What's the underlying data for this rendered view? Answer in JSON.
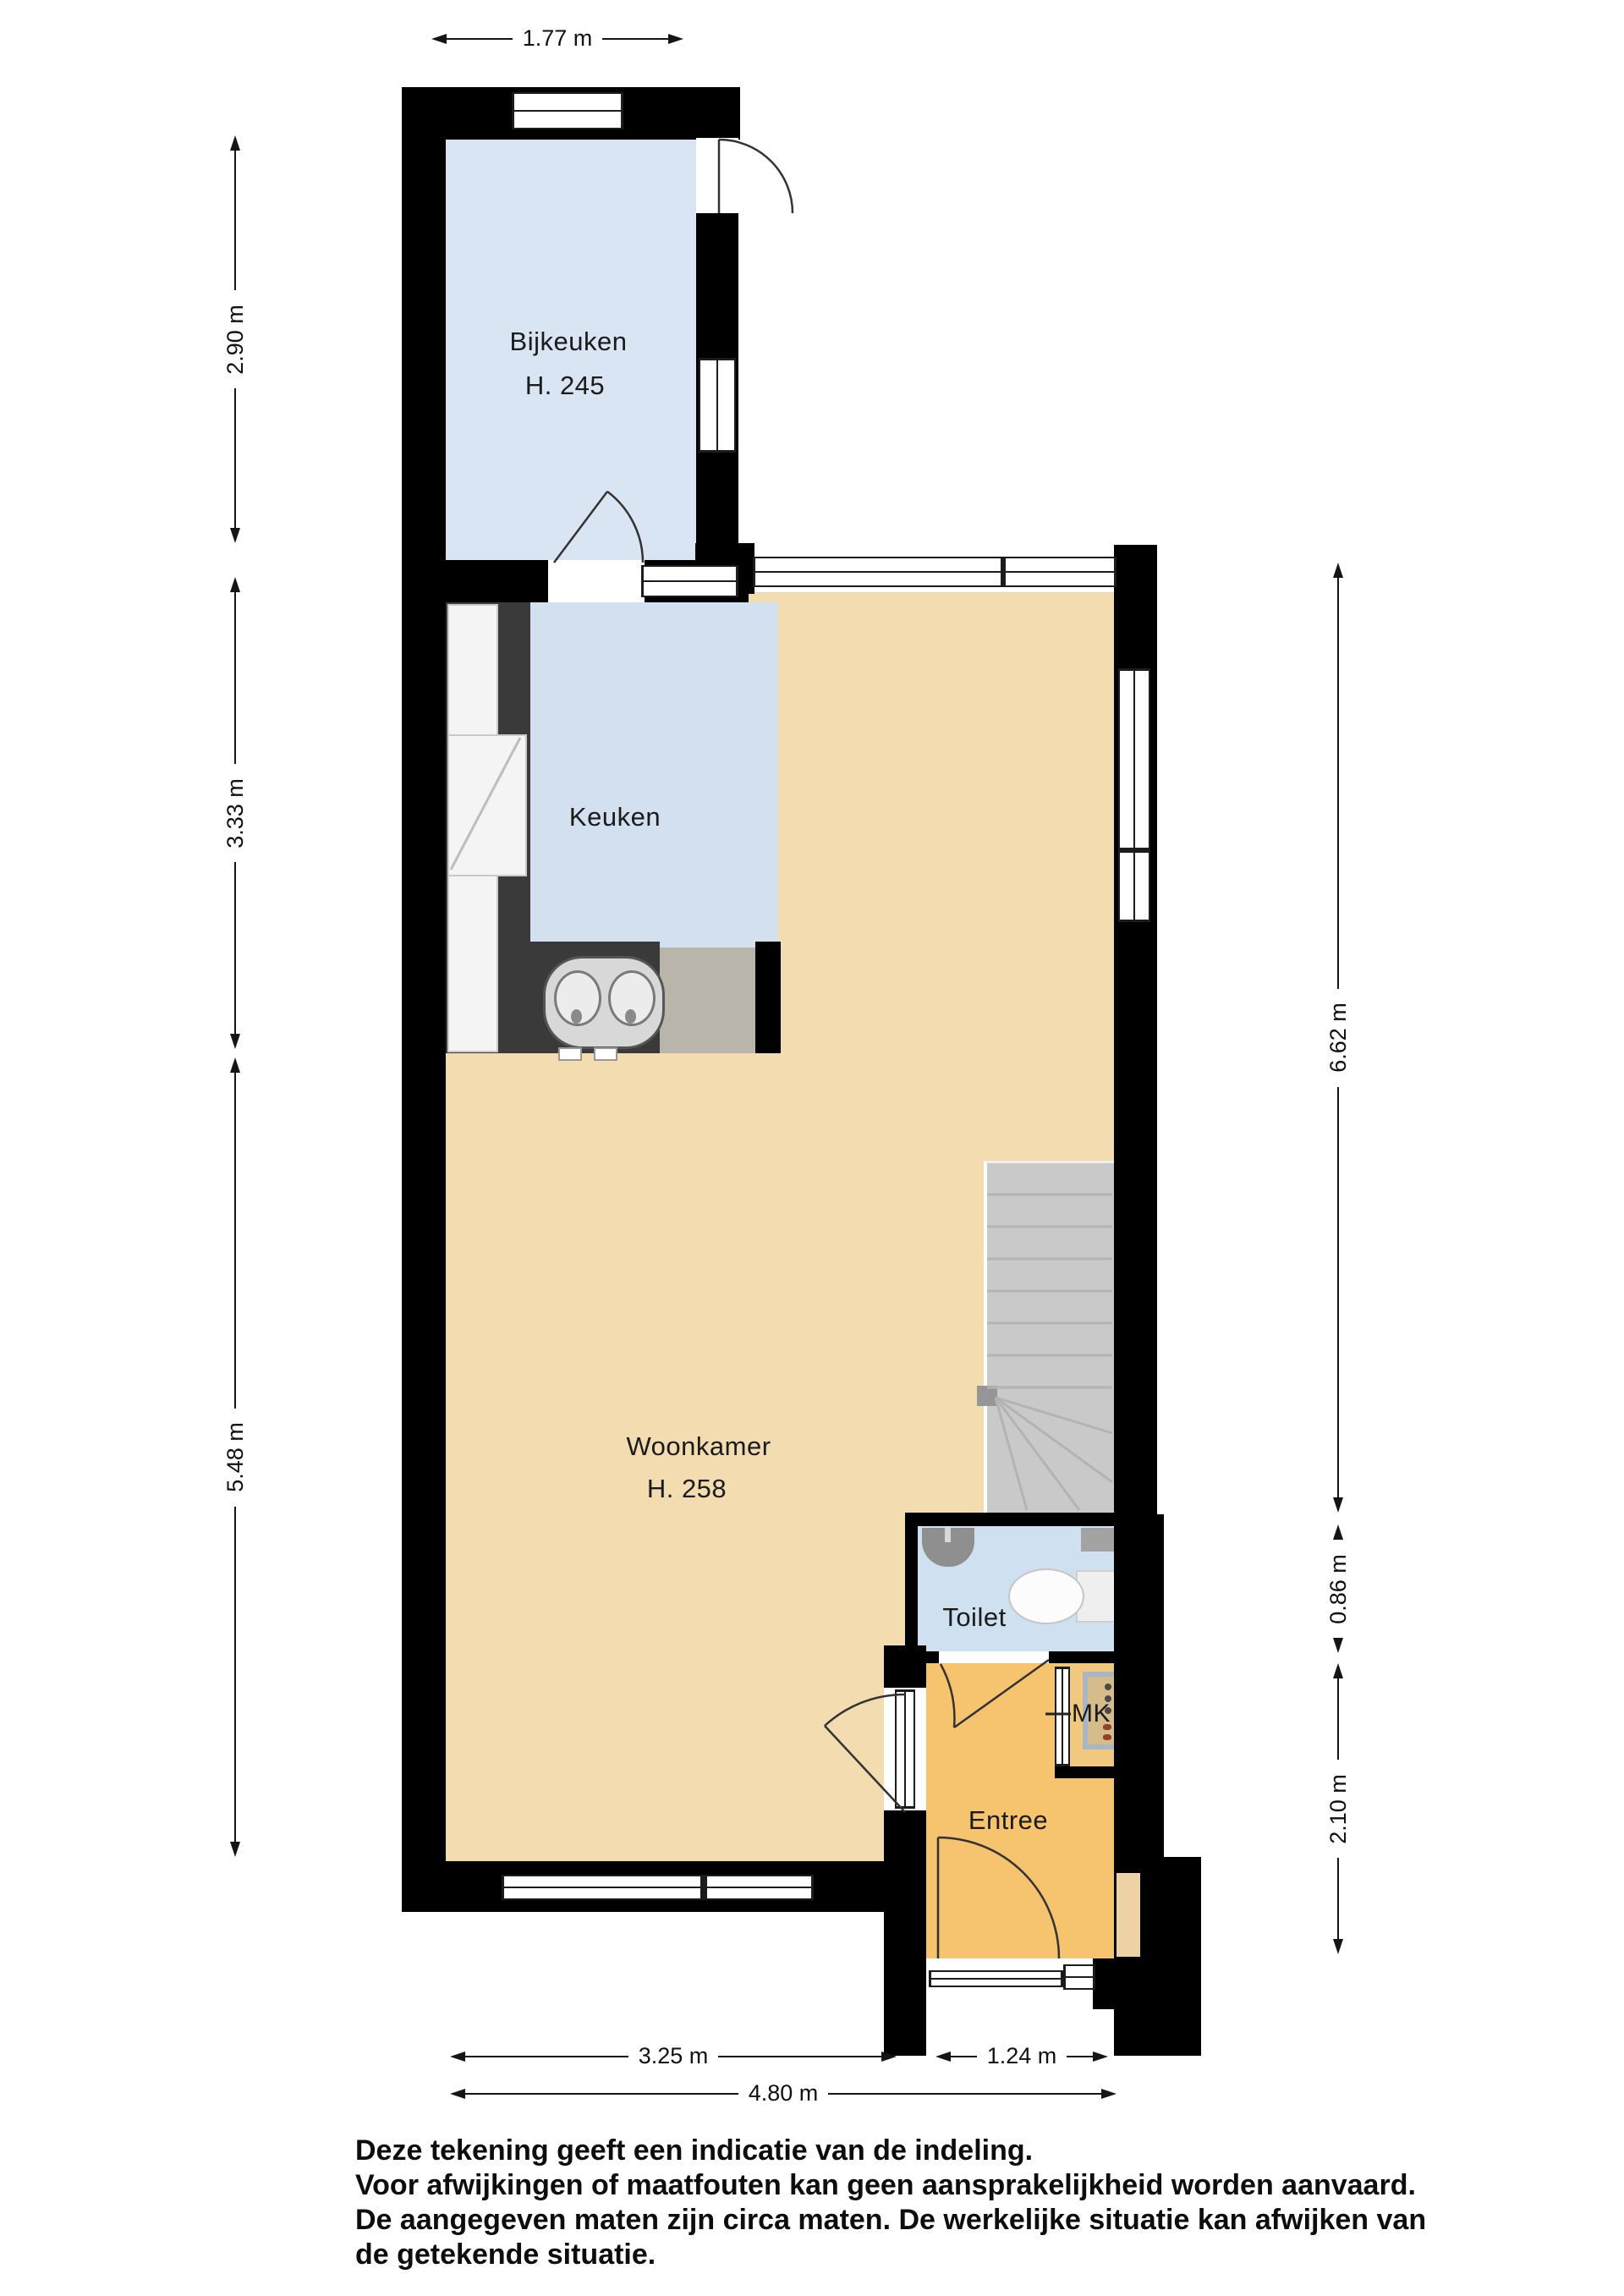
{
  "plan": {
    "rooms": {
      "bijkeuken": {
        "label": "Bijkeuken",
        "height": "H. 245"
      },
      "keuken": {
        "label": "Keuken"
      },
      "woonkamer": {
        "label": "Woonkamer",
        "height": "H. 258"
      },
      "toilet": {
        "label": "Toilet"
      },
      "mk": {
        "label": "MK"
      },
      "entree": {
        "label": "Entree"
      }
    },
    "dimensions": {
      "top_width": "1.77 m",
      "left_top": "2.90 m",
      "left_middle": "3.33 m",
      "left_bottom": "5.48 m",
      "right_top": "6.62 m",
      "right_middle": "0.86 m",
      "right_bottom": "2.10 m",
      "bottom_left": "3.25 m",
      "bottom_right": "1.24 m",
      "bottom_total": "4.80 m"
    },
    "disclaimer": {
      "line1": "Deze tekening geeft een indicatie van de indeling.",
      "line2": "Voor  afwijkingen of maatfouten kan geen aansprakelijkheid worden aanvaard.",
      "line3": "De aangegeven maten zijn circa maten. De werkelijke situatie kan afwijken van",
      "line4": "de getekende situatie."
    }
  },
  "colors": {
    "wall": "#000000",
    "line": "#151515",
    "bijkeuken": "#d9e5f2",
    "keuken": "#d2e0f0",
    "toilet": "#cfe0f0",
    "woonkamer": "#f2dcb0",
    "entree": "#f6c36e",
    "mk-floor": "#f0c97f",
    "stairs": "#c9c9c9",
    "counter-dark": "#3a3a3a",
    "counter-light": "#b9b5ab",
    "fixture-white": "#f4f4f4",
    "mk-panel": "#d6bc8a",
    "mk-panel-border": "#a9b6c4",
    "niche": "#ecd2a4"
  }
}
